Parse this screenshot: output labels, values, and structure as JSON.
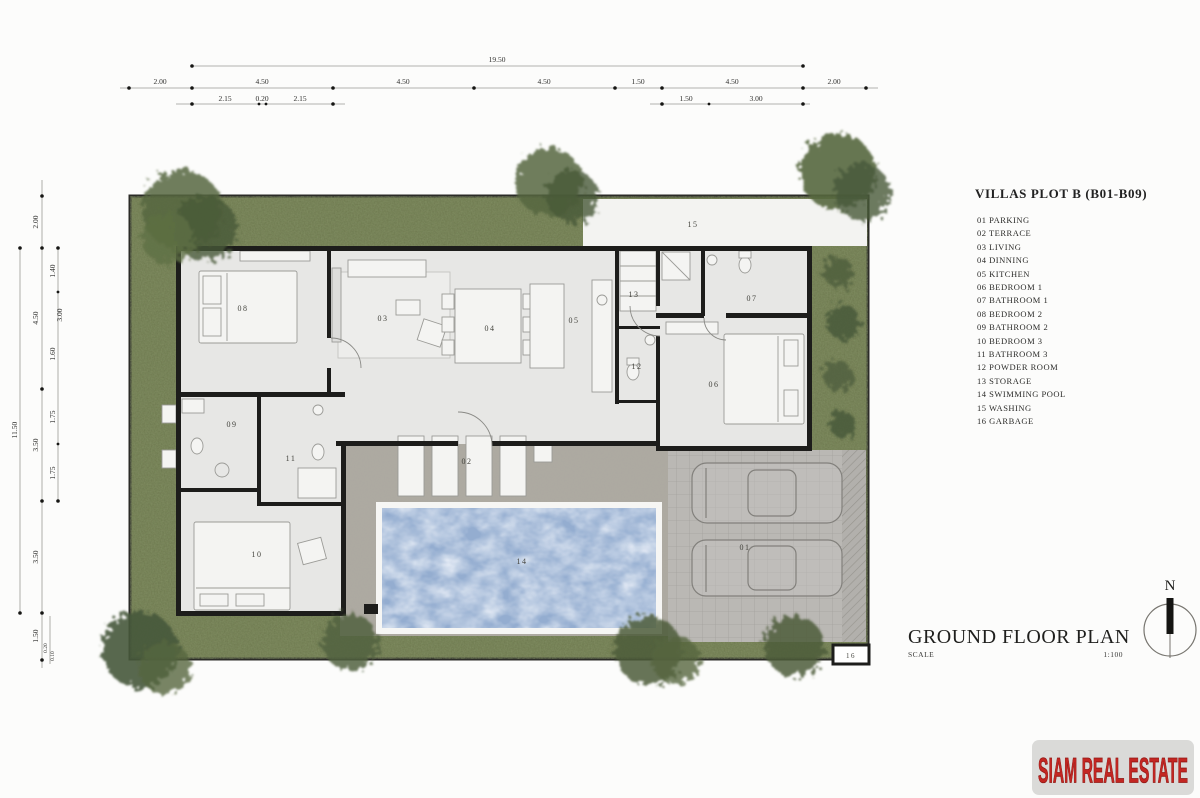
{
  "legend": {
    "title": "VILLAS  PLOT B (B01-B09)",
    "items": [
      "01 PARKING",
      "02 TERRACE",
      "03 LIVING",
      "04 DINNING",
      "05 KITCHEN",
      "06 BEDROOM 1",
      "07 BATHROOM 1",
      "08 BEDROOM 2",
      "09 BATHROOM 2",
      "10 BEDROOM 3",
      "11 BATHROOM 3",
      "12 POWDER ROOM",
      "13 STORAGE",
      "14 SWIMMING POOL",
      "15 WASHING",
      "16 GARBAGE"
    ]
  },
  "plan": {
    "labels": [
      "01",
      "02",
      "03",
      "04",
      "05",
      "06",
      "07",
      "08",
      "09",
      "10",
      "11",
      "12",
      "13",
      "14",
      "15",
      "16"
    ]
  },
  "dims": {
    "top": {
      "total": "19.50",
      "segments": [
        "2.00",
        "4.50",
        "4.50",
        "4.50",
        "1.50",
        "4.50",
        "2.00"
      ],
      "subsegments": [
        "2.15",
        "0.20",
        "2.15",
        "1.50",
        "3.00"
      ]
    },
    "left": {
      "total": "11.50",
      "segments": [
        "2.00",
        "4.50",
        "3.50",
        "3.50",
        "1.50"
      ],
      "subsegments": [
        "1.40",
        "3.00",
        "1.60",
        "1.75",
        "1.75",
        "0.20",
        "0.10"
      ]
    }
  },
  "title_block": {
    "title": "GROUND FLOOR PLAN",
    "scale_label": "SCALE",
    "scale_value": "1:100"
  },
  "compass": {
    "label": "N"
  },
  "watermark": {
    "text": "SIAM REAL ESTATE"
  },
  "colors": {
    "grass_green": "#6b754c",
    "pool_blue": "#94add0",
    "wall_black": "#1d1d1b",
    "terrace_gray": "#aca8a1",
    "parking_gray": "#bab8b4",
    "watermark_red": "#c32622"
  }
}
